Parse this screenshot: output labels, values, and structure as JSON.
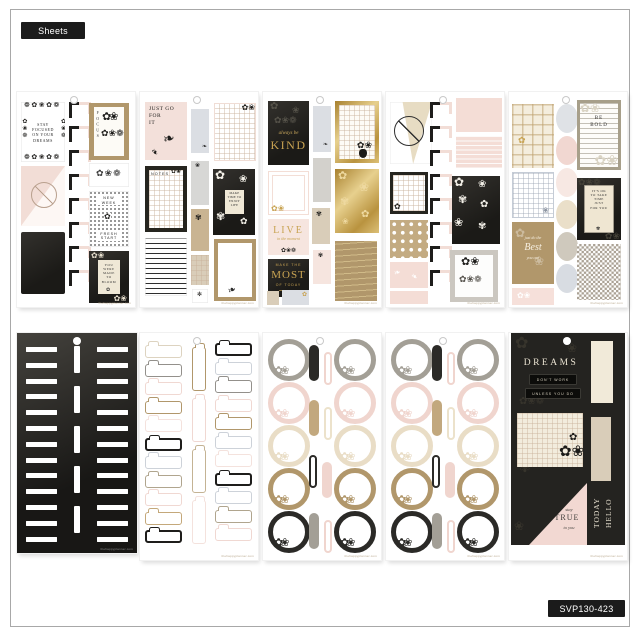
{
  "t": {
    "sheets_label": "Sheets",
    "sku": "SVP130-423",
    "wm": "thehappyplanner.com",
    "s1_stay": "STAY\nFOCUSED\nON YOUR\nDREAMS",
    "s1_focus": "FOCUS",
    "s1_new_week": "NEW\nWEEK",
    "s1_fresh": "FRESH\nSTART",
    "s1_bloom": "YOU\nWERE\nMADE\nTO\nBLOOM",
    "s2_justgo": "JUST GO\nFOR\nIT",
    "s2_notes": "NOTES",
    "s2_maketime": "MAKE\nTIME TO\nENJOY\nLIFE",
    "s3_always": "always be",
    "s3_kind": "KIND",
    "s3_live": "LIVE",
    "s3_inthe": "in the moment",
    "s3_makethe": "MAKE THE",
    "s3_most": "MOST",
    "s3_oftoday": "OF TODAY",
    "s5_bebold": "BE\nBOLD",
    "s5_itsok": "IT'S OK\nTO TAKE\nTIME\nJUST\nFOR YOU",
    "s5_justdo": "just do the",
    "s5_best": "Best",
    "s5_youcan": "you can",
    "s10_dreams": "DREAMS",
    "s10_dont": "DON'T WORK",
    "s10_unless": "UNLESS YOU DO",
    "s10_stay": "stay",
    "s10_true": "TRUE",
    "s10_toyou": "to you",
    "s10_hello": "HELLO",
    "s10_today": "TODAY"
  },
  "g": {
    "row": "❁✿❀✿❁",
    "trio": "✿❀❁",
    "pair": "✿❀",
    "one": "✿",
    "alt": "✾",
    "bloom": "❀",
    "branch": "❧",
    "spark": "✻"
  },
  "colors": {
    "black": "#1e1d1b",
    "blush": "#f2ddd6",
    "pink": "#f0d5ce",
    "tan": "#b1976b",
    "cream": "#e9ddc6",
    "grey": "#a39f96",
    "greyblue": "#d8dce1",
    "gold": "#c8a352"
  },
  "repeats": {
    "s1_corners": [
      "#1e1d1b",
      "#1e1d1b",
      "#1e1d1b",
      "#1e1d1b",
      "#1e1d1b",
      "#1e1d1b",
      "#1e1d1b",
      "#1e1d1b"
    ],
    "s4_corners": [
      "#1e1d1b",
      "#1e1d1b",
      "#1e1d1b",
      "#1e1d1b",
      "#1e1d1b",
      "#1e1d1b",
      "#1e1d1b",
      "#1e1d1b"
    ],
    "s5_ovals": [
      "#dfe2e6",
      "#f1d7d1",
      "#f7e8e3",
      "#eadfc9",
      "#cfc9bd",
      "#d8dce2"
    ],
    "s6_strips": [
      "#ffffff",
      "#ffffff",
      "#ffffff",
      "#ffffff",
      "#ffffff",
      "#ffffff",
      "#ffffff",
      "#ffffff",
      "#ffffff",
      "#ffffff",
      "#ffffff",
      "#ffffff",
      "#ffffff"
    ],
    "s6_vstrips": [
      "#ffffff",
      "#ffffff",
      "#ffffff",
      "#ffffff",
      "#ffffff"
    ],
    "s7_left": [
      "#ddd3c0",
      "#93908b",
      "#f0d8d2",
      "#b1976b",
      "#f4e2dd",
      {
        "c": "#1e1d1b",
        "cls": "bold"
      },
      "#cdd2d9",
      "#b0a58e",
      "#f0d8d2",
      "#c4a87a",
      {
        "c": "#1e1d1b",
        "cls": "bold"
      }
    ],
    "s7_right": [
      {
        "c": "#1e1d1b",
        "cls": "bold"
      },
      "#cdd2d9",
      "#93908b",
      "#f0d8d2",
      "#b1976b",
      "#cdd2d9",
      "#f4e2dd",
      {
        "c": "#1e1d1b",
        "cls": "bold"
      },
      "#cdd2d9",
      "#b0a58e",
      "#f0d8d2"
    ],
    "s7_mid": [
      "#b1976b",
      "#f0d8d2",
      "#c4b394",
      "#f4e2dd"
    ],
    "rings": [
      "#a39f96",
      "#f0d5ce",
      "#e9ddc6",
      "#b1976b",
      "#2b2a27"
    ],
    "clips": [
      {
        "c": "#2b2a27",
        "cls": "solid"
      },
      {
        "c": "#f0d5ce",
        "cls": "out dn"
      },
      {
        "c": "#c2a87e",
        "cls": "solid"
      },
      {
        "c": "#ece2cb",
        "cls": "out dn"
      },
      {
        "c": "#2b2a27",
        "cls": "out"
      },
      {
        "c": "#f0d5ce",
        "cls": "solid dn"
      },
      {
        "c": "#a39f96",
        "cls": "solid"
      },
      {
        "c": "#f0d5ce",
        "cls": "out dn"
      }
    ]
  }
}
